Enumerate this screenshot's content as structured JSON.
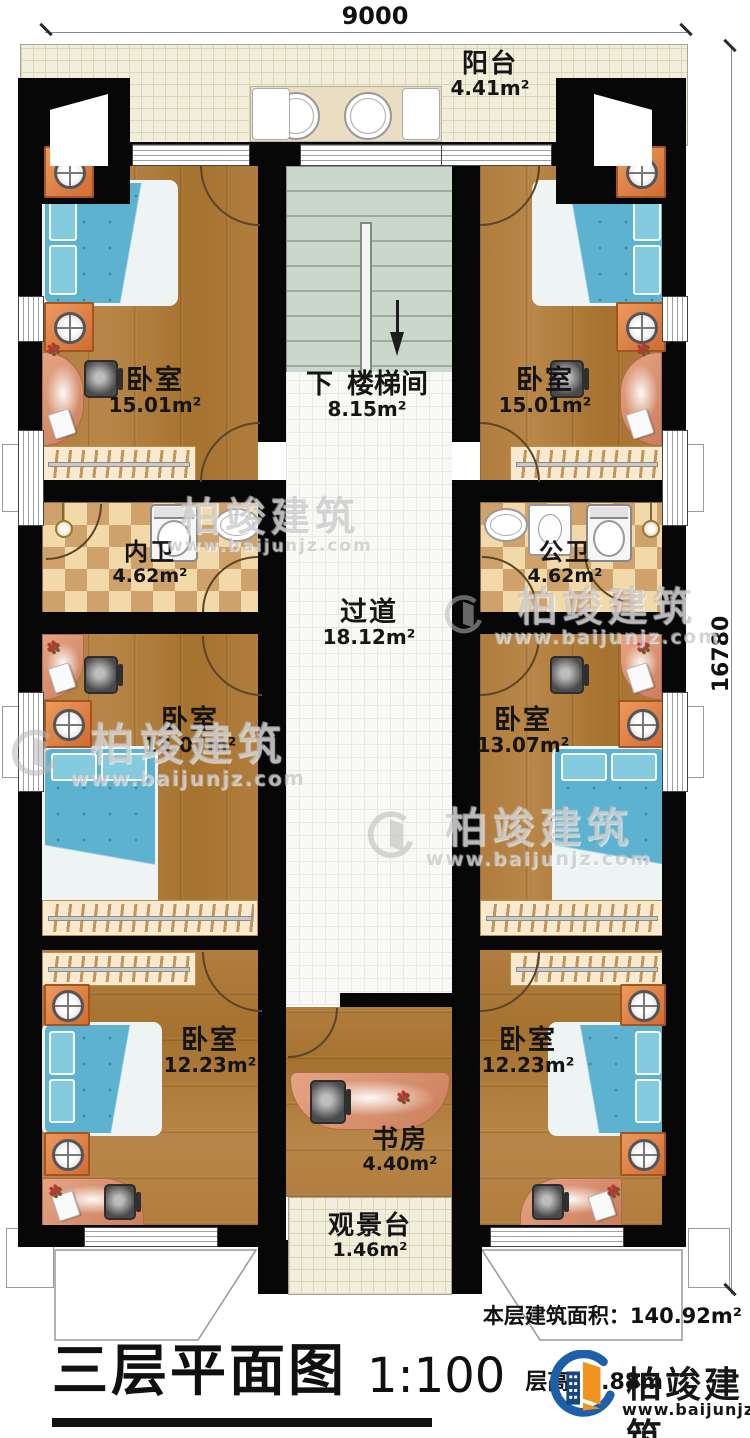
{
  "dimensions": {
    "width_top": "9000",
    "height_right": "16780"
  },
  "rooms": {
    "balcony": {
      "name": "阳台",
      "area": "4.41m²"
    },
    "bedroom_tl": {
      "name": "卧室",
      "area": "15.01m²"
    },
    "bedroom_tr": {
      "name": "卧室",
      "area": "15.01m²"
    },
    "stairwell": {
      "down": "下",
      "name": "楼梯间",
      "area": "8.15m²"
    },
    "bath_inner": {
      "name": "内卫",
      "area": "4.62m²"
    },
    "bath_public": {
      "name": "公卫",
      "area": "4.62m²"
    },
    "corridor": {
      "name": "过道",
      "area": "18.12m²"
    },
    "bedroom_ml": {
      "name": "卧室",
      "area": "13.07m²"
    },
    "bedroom_mr": {
      "name": "卧室",
      "area": "13.07m²"
    },
    "bedroom_bl": {
      "name": "卧室",
      "area": "12.23m²"
    },
    "bedroom_br": {
      "name": "卧室",
      "area": "12.23m²"
    },
    "study": {
      "name": "书房",
      "area": "4.40m²"
    },
    "view_deck": {
      "name": "观景台",
      "area": "1.46m²"
    }
  },
  "footer": {
    "floor_area": "本层建筑面积：140.92m²",
    "title": "三层平面图",
    "scale": "1:100",
    "storey_height": "层高: 2.88m",
    "brand": "柏竣建筑",
    "brand_url": "www.baijunjz.com"
  },
  "watermark": {
    "brand": "柏竣建筑",
    "url": "www.baijunjz.com"
  },
  "colors": {
    "wall": "#070707",
    "wood": "#b07d3e",
    "bed": "#5db3cf",
    "bath_tile": "#cfa26b",
    "balcony": "#f1eedc",
    "stair": "#ccd7cb",
    "brand_blue": "#1d5fa8",
    "brand_orange": "#f0931f"
  }
}
